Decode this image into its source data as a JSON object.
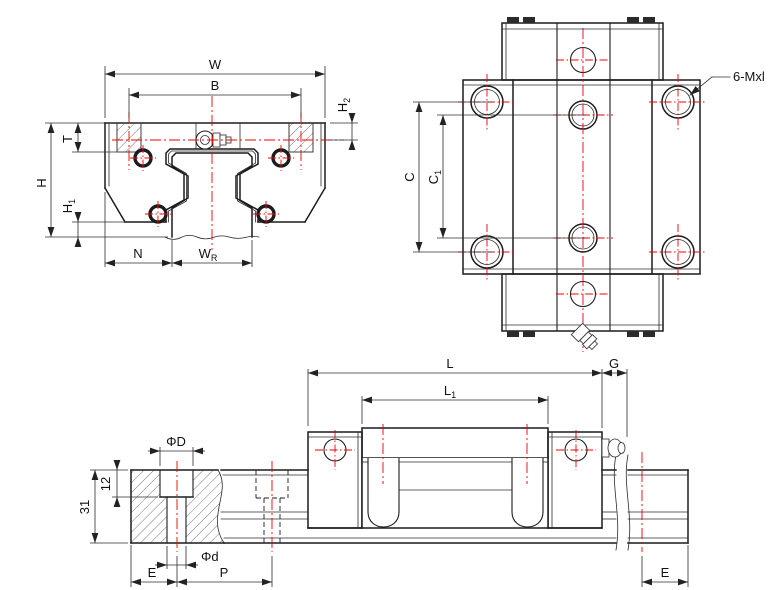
{
  "drawing_type": "engineering-drawing",
  "component": "linear-guide-block-and-rail",
  "colors": {
    "line": "#1c1c1c",
    "centerline": "#f00000",
    "hatch": "#555555",
    "background": "#ffffff"
  },
  "views": {
    "front": {
      "name": "front-view",
      "dims": {
        "W": "W",
        "B": "B",
        "T": "T",
        "H": "H",
        "H1_main": "H",
        "H1_sub": "1",
        "H2_main": "H",
        "H2_sub": "2",
        "N": "N",
        "WR_main": "W",
        "WR_sub": "R"
      }
    },
    "top": {
      "name": "top-view",
      "dims": {
        "C": "C",
        "C1_main": "C",
        "C1_sub": "1"
      },
      "thread_note": "6-Mxl"
    },
    "side": {
      "name": "side-view",
      "dims": {
        "L": "L",
        "L1_main": "L",
        "L1_sub": "1",
        "G": "G",
        "E_left": "E",
        "P": "P",
        "E_right": "E",
        "bolt_counterbore_dia": "ΦD",
        "bolt_hole_dia": "Φd",
        "counterbore_depth": "12",
        "rail_height": "31"
      }
    }
  }
}
